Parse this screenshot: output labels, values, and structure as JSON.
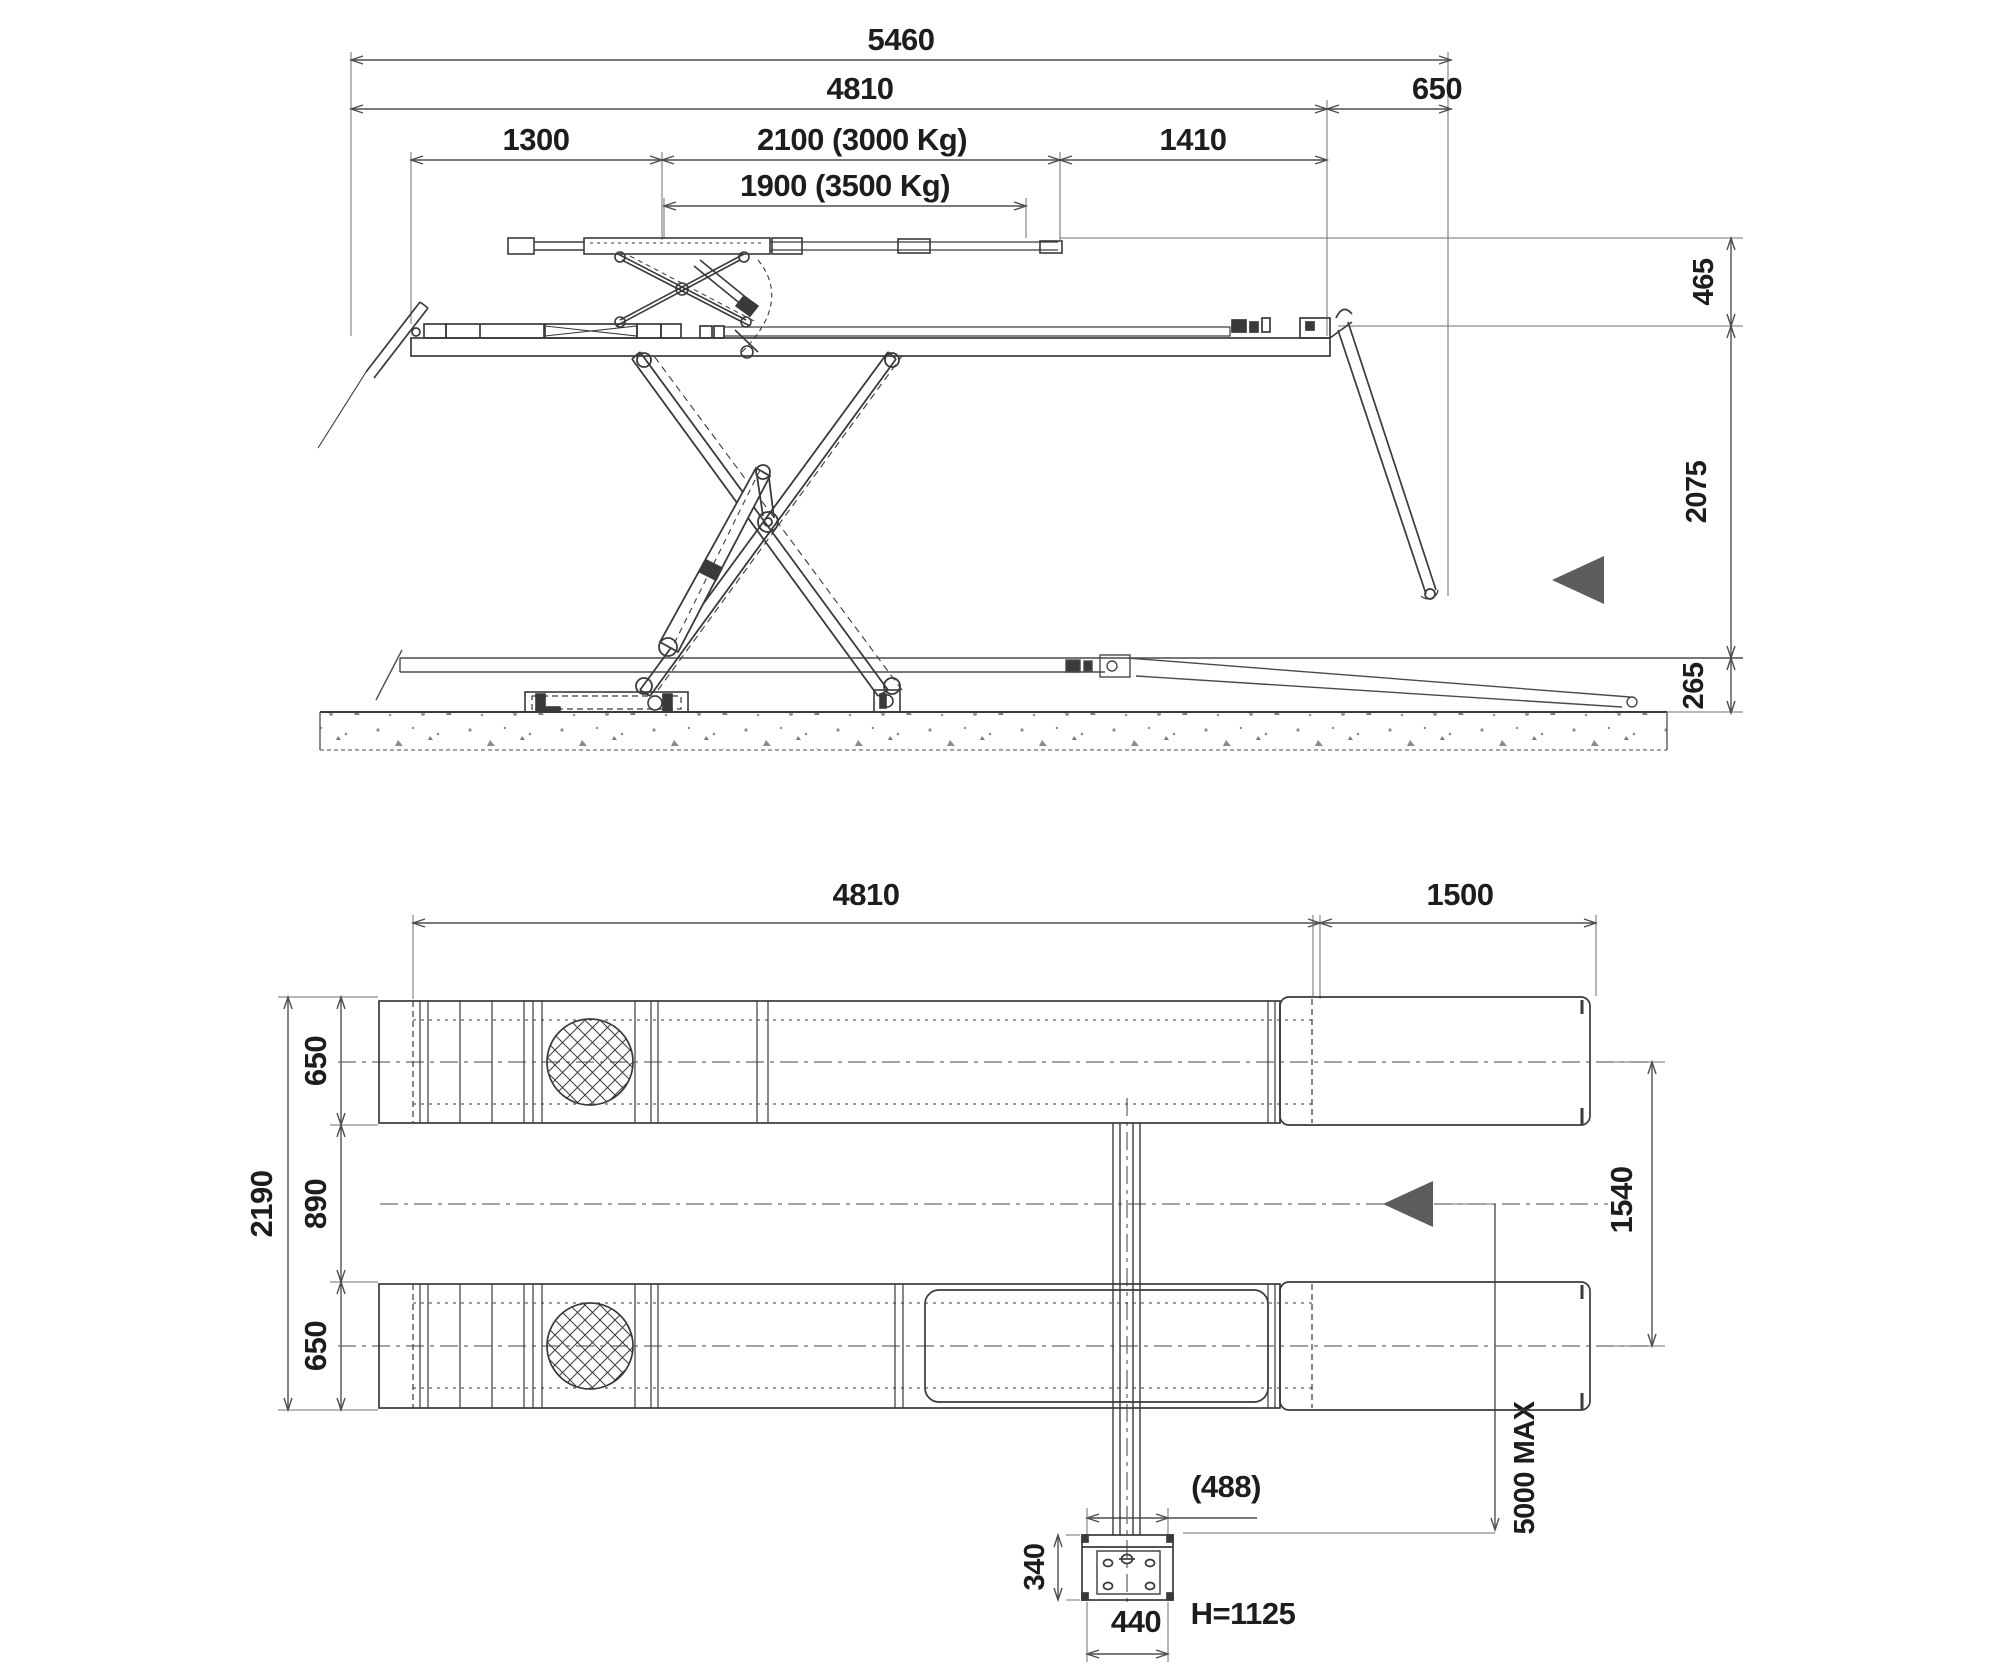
{
  "colors": {
    "line": "#3a3a3a",
    "dim_line": "#4f4f4f",
    "ext_line": "#6f6f6f",
    "text": "#1d1d1d",
    "arrow_fill": "#5c5d5f",
    "concrete_speck": "#8e8e8e"
  },
  "side_view": {
    "total_length": "5460",
    "platform_length": "4810",
    "rear_ramp_length": "650",
    "front_section": "1300",
    "pad_span_3000": "2100 (3000 Kg)",
    "rear_section": "1410",
    "pad_span_3500": "1900 (3500 Kg)",
    "free_lift_height": "465",
    "raised_height": "2075",
    "lowered_height": "265"
  },
  "plan_view": {
    "platform_length": "4810",
    "ramp_length": "1500",
    "overall_width": "2190",
    "runway_width_front": "650",
    "runway_gap": "890",
    "runway_width_rear": "650",
    "track_centre_distance": "1540",
    "cable_run_max": "5000 MAX",
    "console_offset": "(488)",
    "console_depth": "340",
    "console_width": "440",
    "console_height": "H=1125"
  }
}
